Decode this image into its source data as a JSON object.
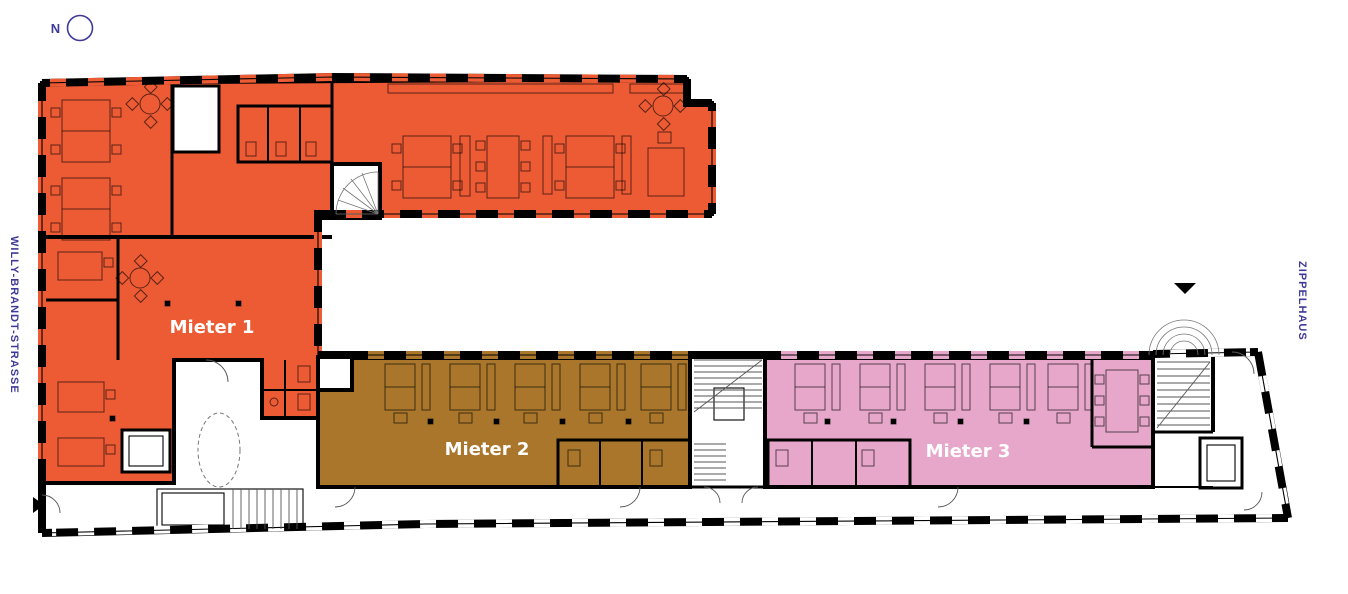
{
  "compass": {
    "label": "N"
  },
  "streets": {
    "left_label": "WILLY-BRANDT-STRASSE",
    "right_label": "ZIPPELHAUS",
    "text_color": "#3E3A99"
  },
  "tenants": [
    {
      "name": "Mieter 1",
      "color": "#ED5B35"
    },
    {
      "name": "Mieter 2",
      "color": "#A9762B"
    },
    {
      "name": "Mieter 3",
      "color": "#E7A7CB"
    }
  ],
  "plan": {
    "wall_color": "#000000",
    "tenant_label_color": "#FFFFFF",
    "background": "#FFFFFF"
  }
}
